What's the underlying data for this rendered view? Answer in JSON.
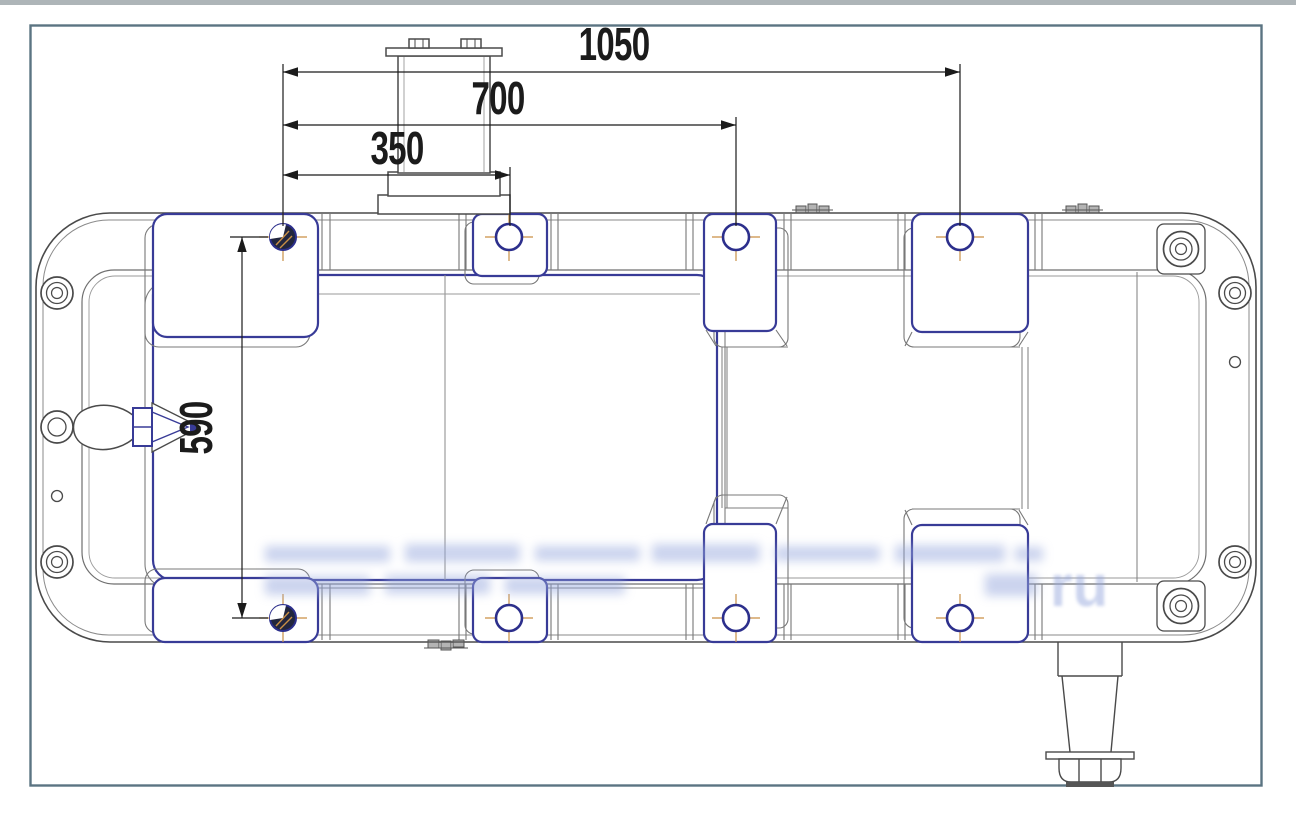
{
  "drawing": {
    "kind": "technical-drawing-top-view",
    "colors": {
      "frame": "#5b7482",
      "line_main": "#4a4a4a",
      "line_secondary": "#808080",
      "accent_blue": "#383b97",
      "hole_navy": "#2c2f8c",
      "centerline_orange": "#c98f45",
      "dimension_text": "#1b1b1b",
      "watermark": "#96a7dd"
    }
  },
  "dims": {
    "d1050": {
      "label": "1050",
      "orientation": "horizontal"
    },
    "d700": {
      "label": "700",
      "orientation": "horizontal"
    },
    "d350": {
      "label": "350",
      "orientation": "horizontal"
    },
    "d590": {
      "label": "590",
      "orientation": "vertical"
    }
  },
  "watermark": {
    "visible_fragment": "ru"
  }
}
